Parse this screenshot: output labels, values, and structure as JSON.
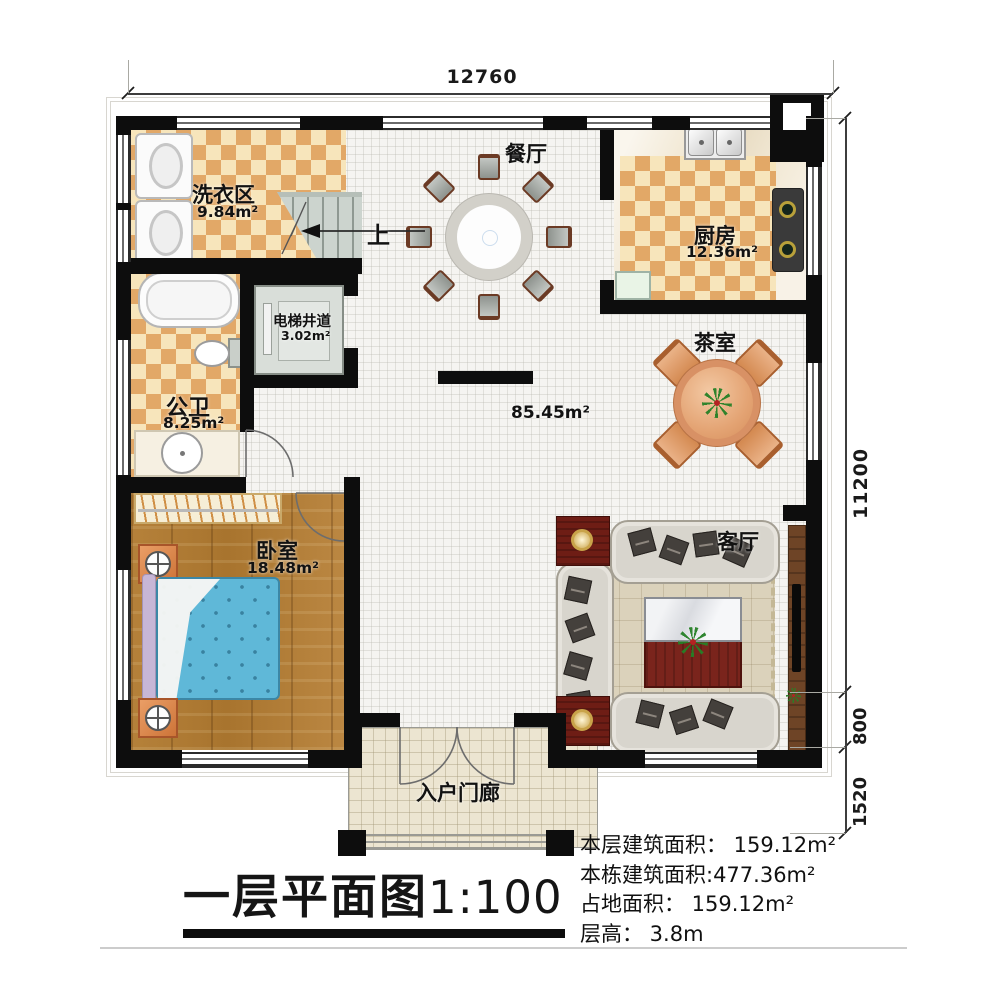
{
  "dimensions": {
    "top_width": "12760",
    "right_height": "11200",
    "right_step": "800",
    "right_porch": "1520"
  },
  "rooms": {
    "laundry": {
      "name": "洗衣区",
      "area": "9.84m²"
    },
    "stairs": {
      "up_label": "上"
    },
    "elevator": {
      "name": "电梯井道",
      "area": "3.02m²"
    },
    "bathroom": {
      "name": "公卫",
      "area": "8.25m²"
    },
    "dining": {
      "name": "餐厅"
    },
    "kitchen": {
      "name": "厨房",
      "area": "12.36m²"
    },
    "tea_room": {
      "name": "茶室"
    },
    "hall": {
      "area": "85.45m²"
    },
    "bedroom": {
      "name": "卧室",
      "area": "18.48m²"
    },
    "living_room": {
      "name": "客厅"
    },
    "porch": {
      "name": "入户门廊"
    }
  },
  "footer": {
    "title": "一层平面图",
    "scale": "1:100",
    "lines": [
      "本层建筑面积： 159.12m²",
      "本栋建筑面积:477.36m²",
      "占地面积： 159.12m²",
      "层高： 3.8m"
    ]
  },
  "colors": {
    "wall": "#0d0d0d",
    "tile_accent": "#e2a867",
    "wood_floor": "#b07c36",
    "bed_blue": "#5fb8d8",
    "rug": "#dbd2bb"
  }
}
